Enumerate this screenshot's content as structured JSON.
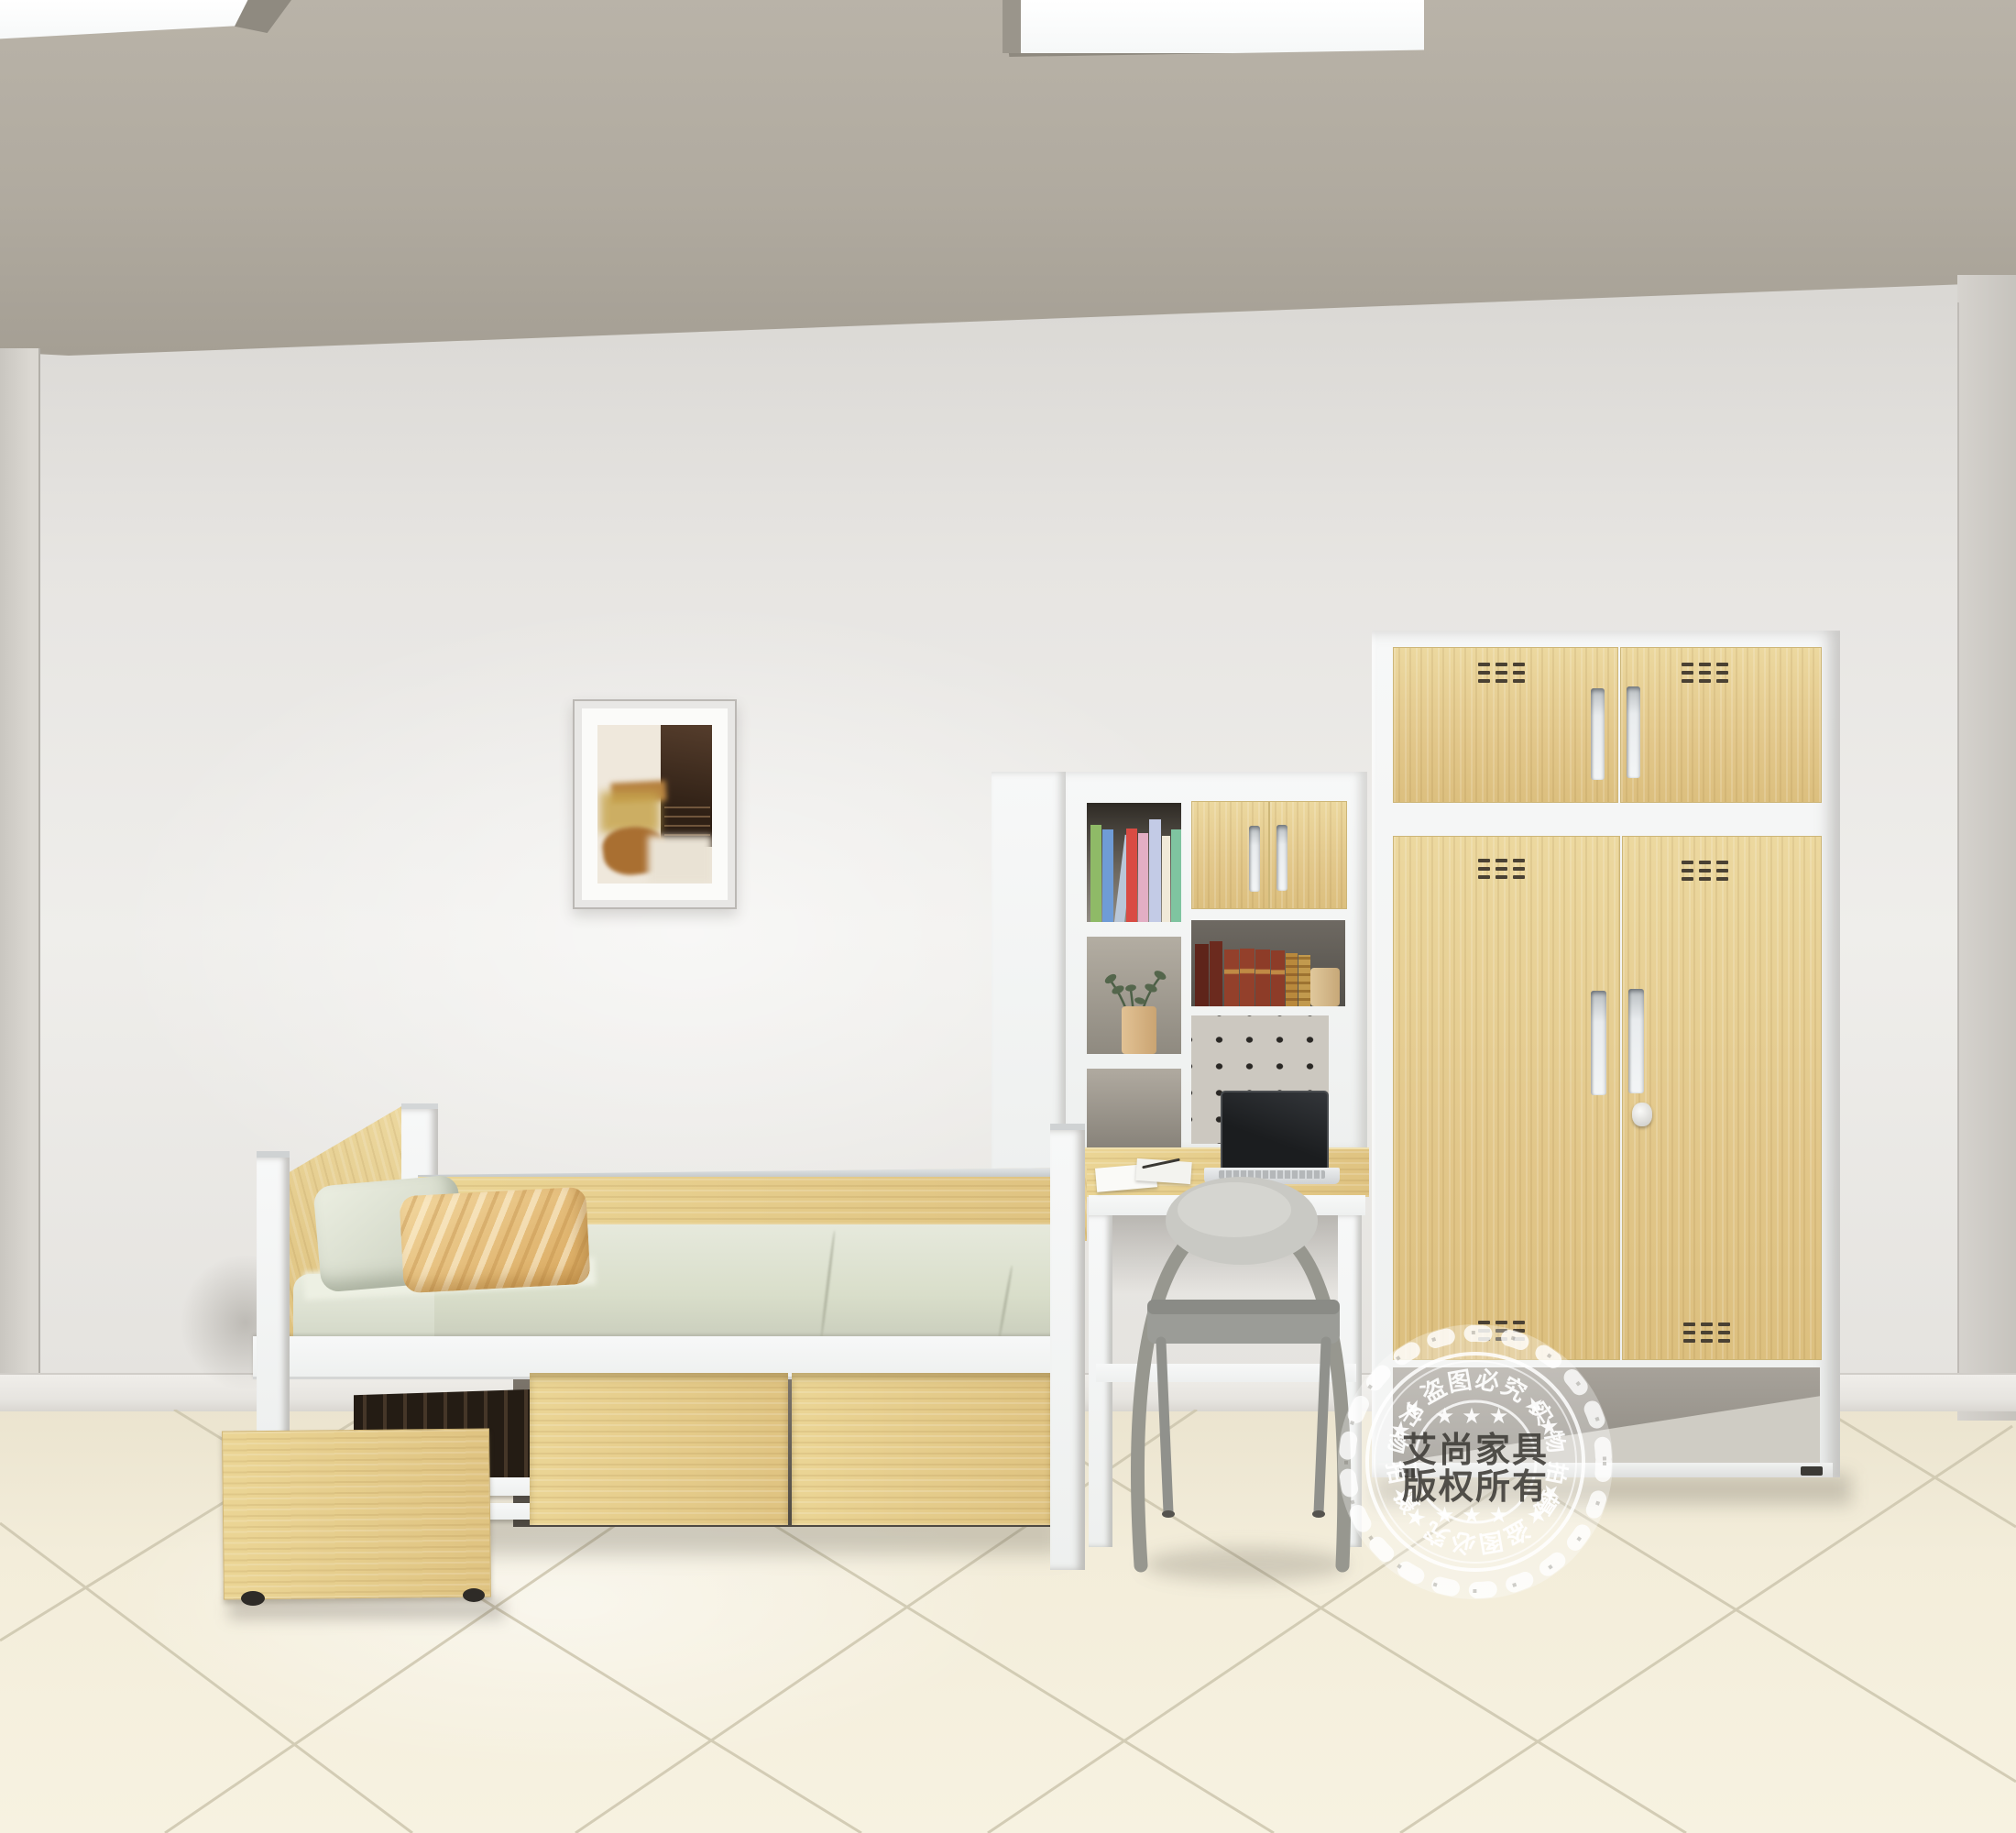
{
  "watermark": {
    "center_line1": "艾尚家具",
    "center_line2": "版权所有",
    "arc_top": "★★盗图必究★★",
    "arc_bottom": "★★盗图必究★★",
    "arc_left": "实物拍摄",
    "arc_right": "实物拍摄",
    "stars_top": "★★★",
    "stars_bottom": "★★★"
  },
  "palette": {
    "wood_light": "#ecd89f",
    "wood_mid": "#dfc383",
    "frame_white": "#f4f5f4",
    "wall": "#e8e6e2",
    "ceiling": "#b0aa9f",
    "floor_tile": "#f3edda",
    "grout": "#cdc6ae",
    "mattress_sage": "#dde1d0",
    "pillow_tan": "#e4b66e",
    "chair_gray": "#9a9a96",
    "stamp_white": "#ffffff",
    "stamp_text_dark": "#3e3c38"
  }
}
